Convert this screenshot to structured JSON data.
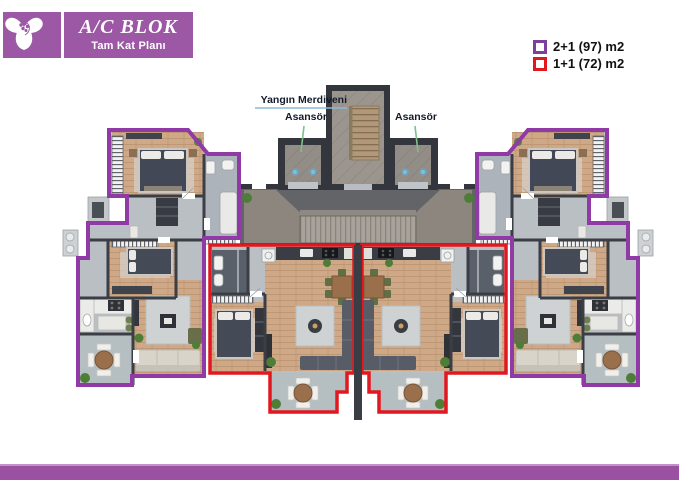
{
  "header": {
    "logo_icon": "trillium-flower-icon",
    "title": "A/C BLOK",
    "subtitle": "Tam Kat Planı",
    "box_color": "#9c57a5"
  },
  "legend": {
    "items": [
      {
        "label": "2+1 (97) m2",
        "swatch_color": "#7e3f9d"
      },
      {
        "label": "1+1 (72) m2",
        "swatch_color": "#e1181f"
      }
    ]
  },
  "plan": {
    "labels": {
      "fire_escape": "Yangın Merdiveni",
      "elevator_left": "Asansör",
      "elevator_right": "Asansör"
    },
    "outline_colors": {
      "type_2plus1": "#8f3aa5",
      "type_1plus1": "#e1181f"
    },
    "leader_colors": {
      "fire_escape_line": "#8fb9d4",
      "elevator_line": "#7cc08e"
    },
    "units": [
      {
        "type": "2+1",
        "area_label": "97 m2",
        "outline": "purple",
        "count_visible": 2
      },
      {
        "type": "1+1",
        "area_label": "72 m2",
        "outline": "red",
        "count_visible": 2
      }
    ]
  },
  "footer": {
    "bar_color": "#9b51a1"
  }
}
